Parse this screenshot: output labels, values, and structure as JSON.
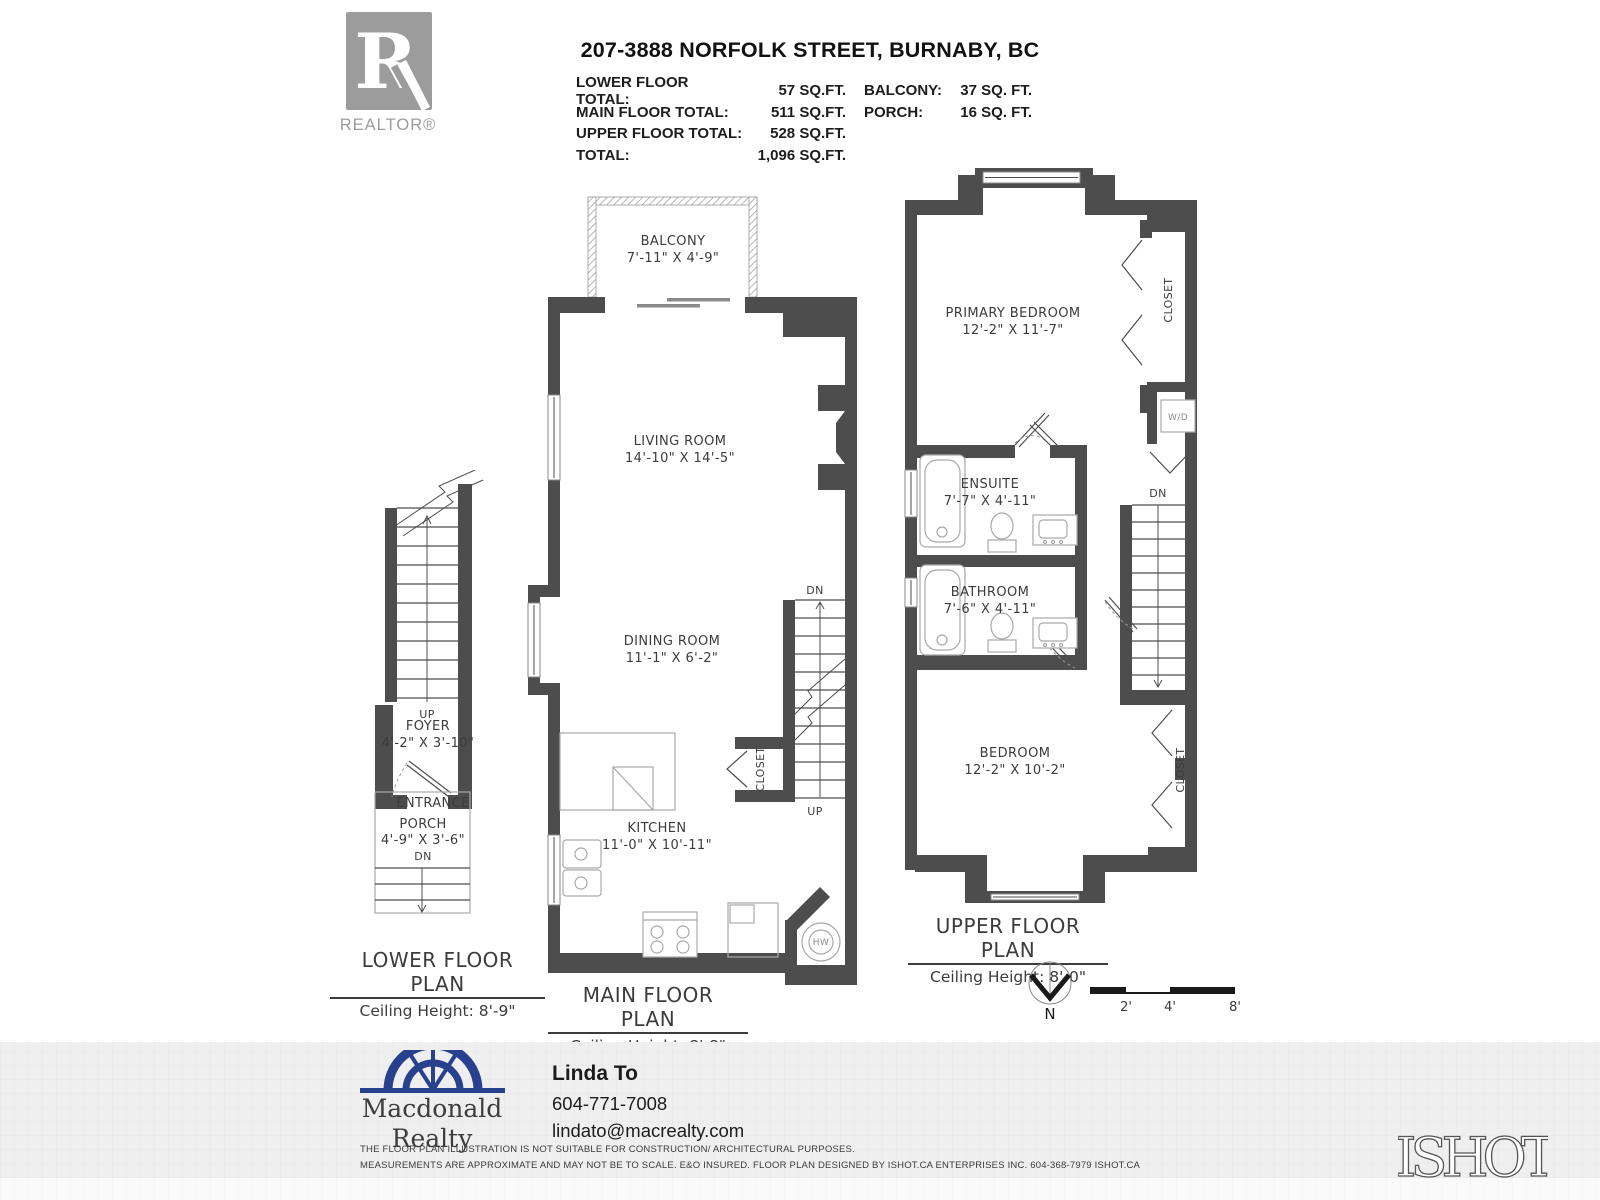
{
  "header": {
    "realtor_badge": "REALTOR®",
    "title": "207-3888 NORFOLK STREET, BURNABY, BC",
    "areas": [
      {
        "label": "LOWER FLOOR TOTAL:",
        "value": "57 SQ.FT.",
        "label2": "BALCONY:",
        "value2": "37 SQ. FT."
      },
      {
        "label": "MAIN FLOOR TOTAL:",
        "value": "511 SQ.FT.",
        "label2": "PORCH:",
        "value2": "16 SQ. FT."
      },
      {
        "label": "UPPER FLOOR TOTAL:",
        "value": "528 SQ.FT."
      },
      {
        "label": "TOTAL:",
        "value": "1,096 SQ.FT."
      }
    ]
  },
  "plans": {
    "lower": {
      "title": "LOWER FLOOR PLAN",
      "ceiling": "Ceiling Height: 8'-9\"",
      "stairs_up": "UP",
      "foyer": {
        "name": "FOYER",
        "dims": "4'-2\" X 3'-10\""
      },
      "entrance": "ENTRANCE",
      "porch": {
        "name": "PORCH",
        "dims": "4'-9\" X 3'-6\"",
        "down": "DN"
      }
    },
    "main": {
      "title": "MAIN FLOOR PLAN",
      "ceiling": "Ceiling Height: 8'-8\"",
      "balcony": {
        "name": "BALCONY",
        "dims": "7'-11\" X 4'-9\""
      },
      "living": {
        "name": "LIVING ROOM",
        "dims": "14'-10\" X 14'-5\""
      },
      "dining": {
        "name": "DINING ROOM",
        "dims": "11'-1\" X 6'-2\""
      },
      "kitchen": {
        "name": "KITCHEN",
        "dims": "11'-0\" X 10'-11\""
      },
      "closet": "CLOSET",
      "stairs_dn": "DN",
      "stairs_up": "UP",
      "hot_water": "HW"
    },
    "upper": {
      "title": "UPPER FLOOR PLAN",
      "ceiling": "Ceiling Height: 8'-0\"",
      "primary": {
        "name": "PRIMARY BEDROOM",
        "dims": "12'-2\" X 11'-7\""
      },
      "closet_top": "CLOSET",
      "washer_dryer": "W/D",
      "ensuite": {
        "name": "ENSUITE",
        "dims": "7'-7\" X 4'-11\""
      },
      "bathroom": {
        "name": "BATHROOM",
        "dims": "7'-6\" X 4'-11\""
      },
      "stairs_dn": "DN",
      "bedroom": {
        "name": "BEDROOM",
        "dims": "12'-2\" X 10'-2\""
      },
      "closet_bottom": "CLOSET"
    }
  },
  "compass": {
    "north": "N"
  },
  "scale_bar": {
    "ticks": [
      "2'",
      "4'",
      "8'"
    ]
  },
  "footer": {
    "brand": {
      "line1": "Macdonald",
      "line2": "Realty"
    },
    "agent": {
      "name": "Linda To",
      "phone": "604-771-7008",
      "email": "lindato@macrealty.com"
    },
    "disclaimer": {
      "line1": "THE FLOOR PLAN ILLUSTRATION IS NOT SUITABLE FOR CONSTRUCTION/ ARCHITECTURAL PURPOSES.",
      "line2": "MEASUREMENTS ARE APPROXIMATE AND MAY NOT BE TO SCALE. E&O INSURED. FLOOR PLAN DESIGNED BY ISHOT.CA ENTERPRISES INC. 604-368-7979  ISHOT.CA"
    },
    "ishot_logo": "ISHOT"
  },
  "colors": {
    "wall": "#4d4d4d",
    "brand_blue": "#27418f",
    "logo_gray": "#9c9c9c",
    "band": "#f0eff0"
  }
}
